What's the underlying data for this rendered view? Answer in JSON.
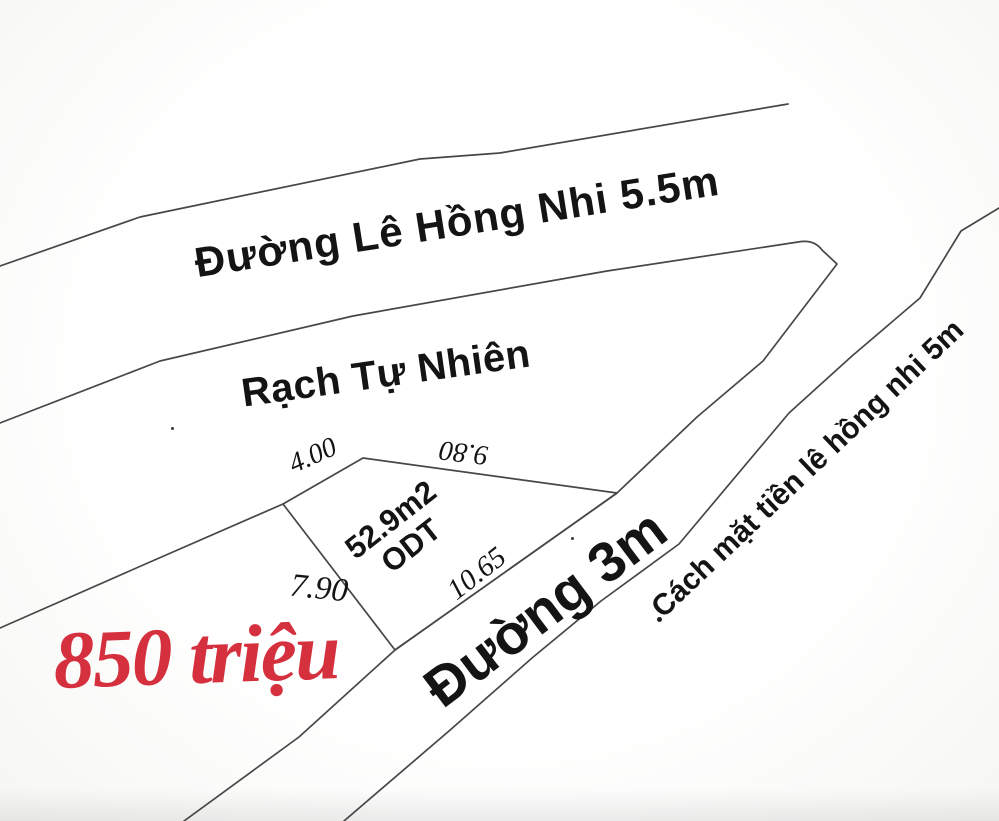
{
  "palette": {
    "ink_line": "#474747",
    "text_black": "#141414",
    "price_red": "#d5303e",
    "paper": "#fbfbfa"
  },
  "labels": {
    "road_top": "Đường Lê Hồng Nhi 5.5m",
    "canal": "Rạch Tự Nhiên",
    "road_diag": "Đường 3m",
    "road_right": "Cách mặt tiền lê hồng nhi 5m",
    "price": "850 triệu"
  },
  "plot": {
    "area": "52.9m2",
    "land_type": "ODT",
    "dims": {
      "top_left": "4.00",
      "top_right": "9.80",
      "left": "7.90",
      "front": "10.65"
    }
  }
}
